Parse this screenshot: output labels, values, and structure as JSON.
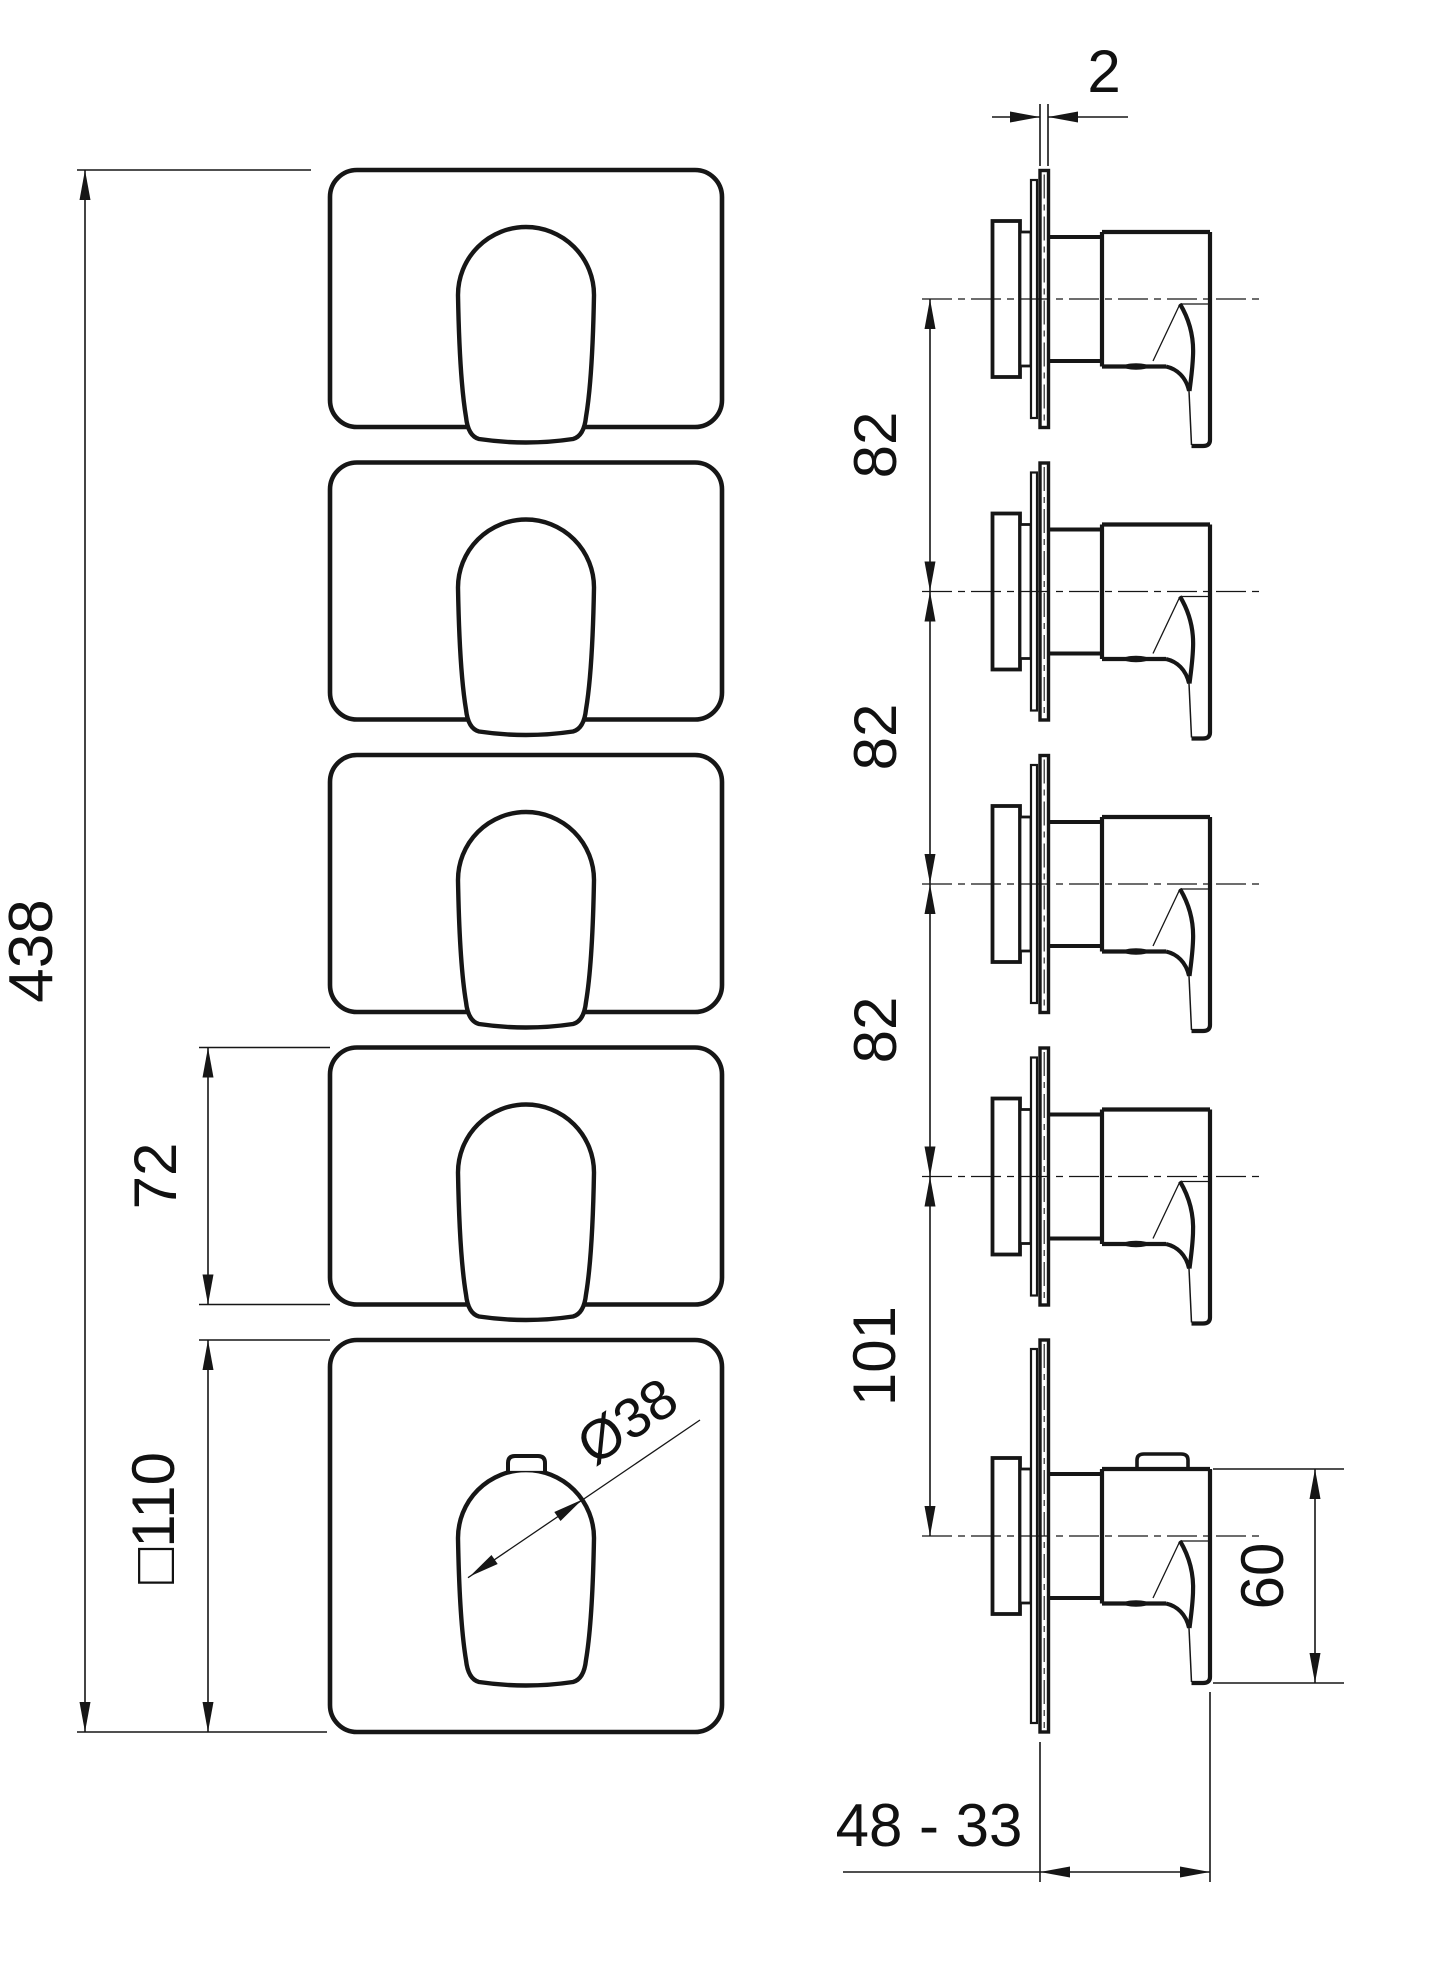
{
  "drawing": {
    "views": {
      "front_view": "front-view-five-plates",
      "side_view": "side-view-five-valves"
    },
    "dimensions": {
      "overall_height": "438",
      "module_plate_height": "72",
      "square_plate": "□110",
      "handle_diameter": "Ø38",
      "plate_thickness": "2",
      "spacing_1": "82",
      "spacing_2": "82",
      "spacing_3": "82",
      "spacing_thermostat": "101",
      "handle_length": "60",
      "installation_depth_range": "48 - 33"
    },
    "colors": {
      "line": "#161616",
      "background": "#ffffff"
    }
  }
}
